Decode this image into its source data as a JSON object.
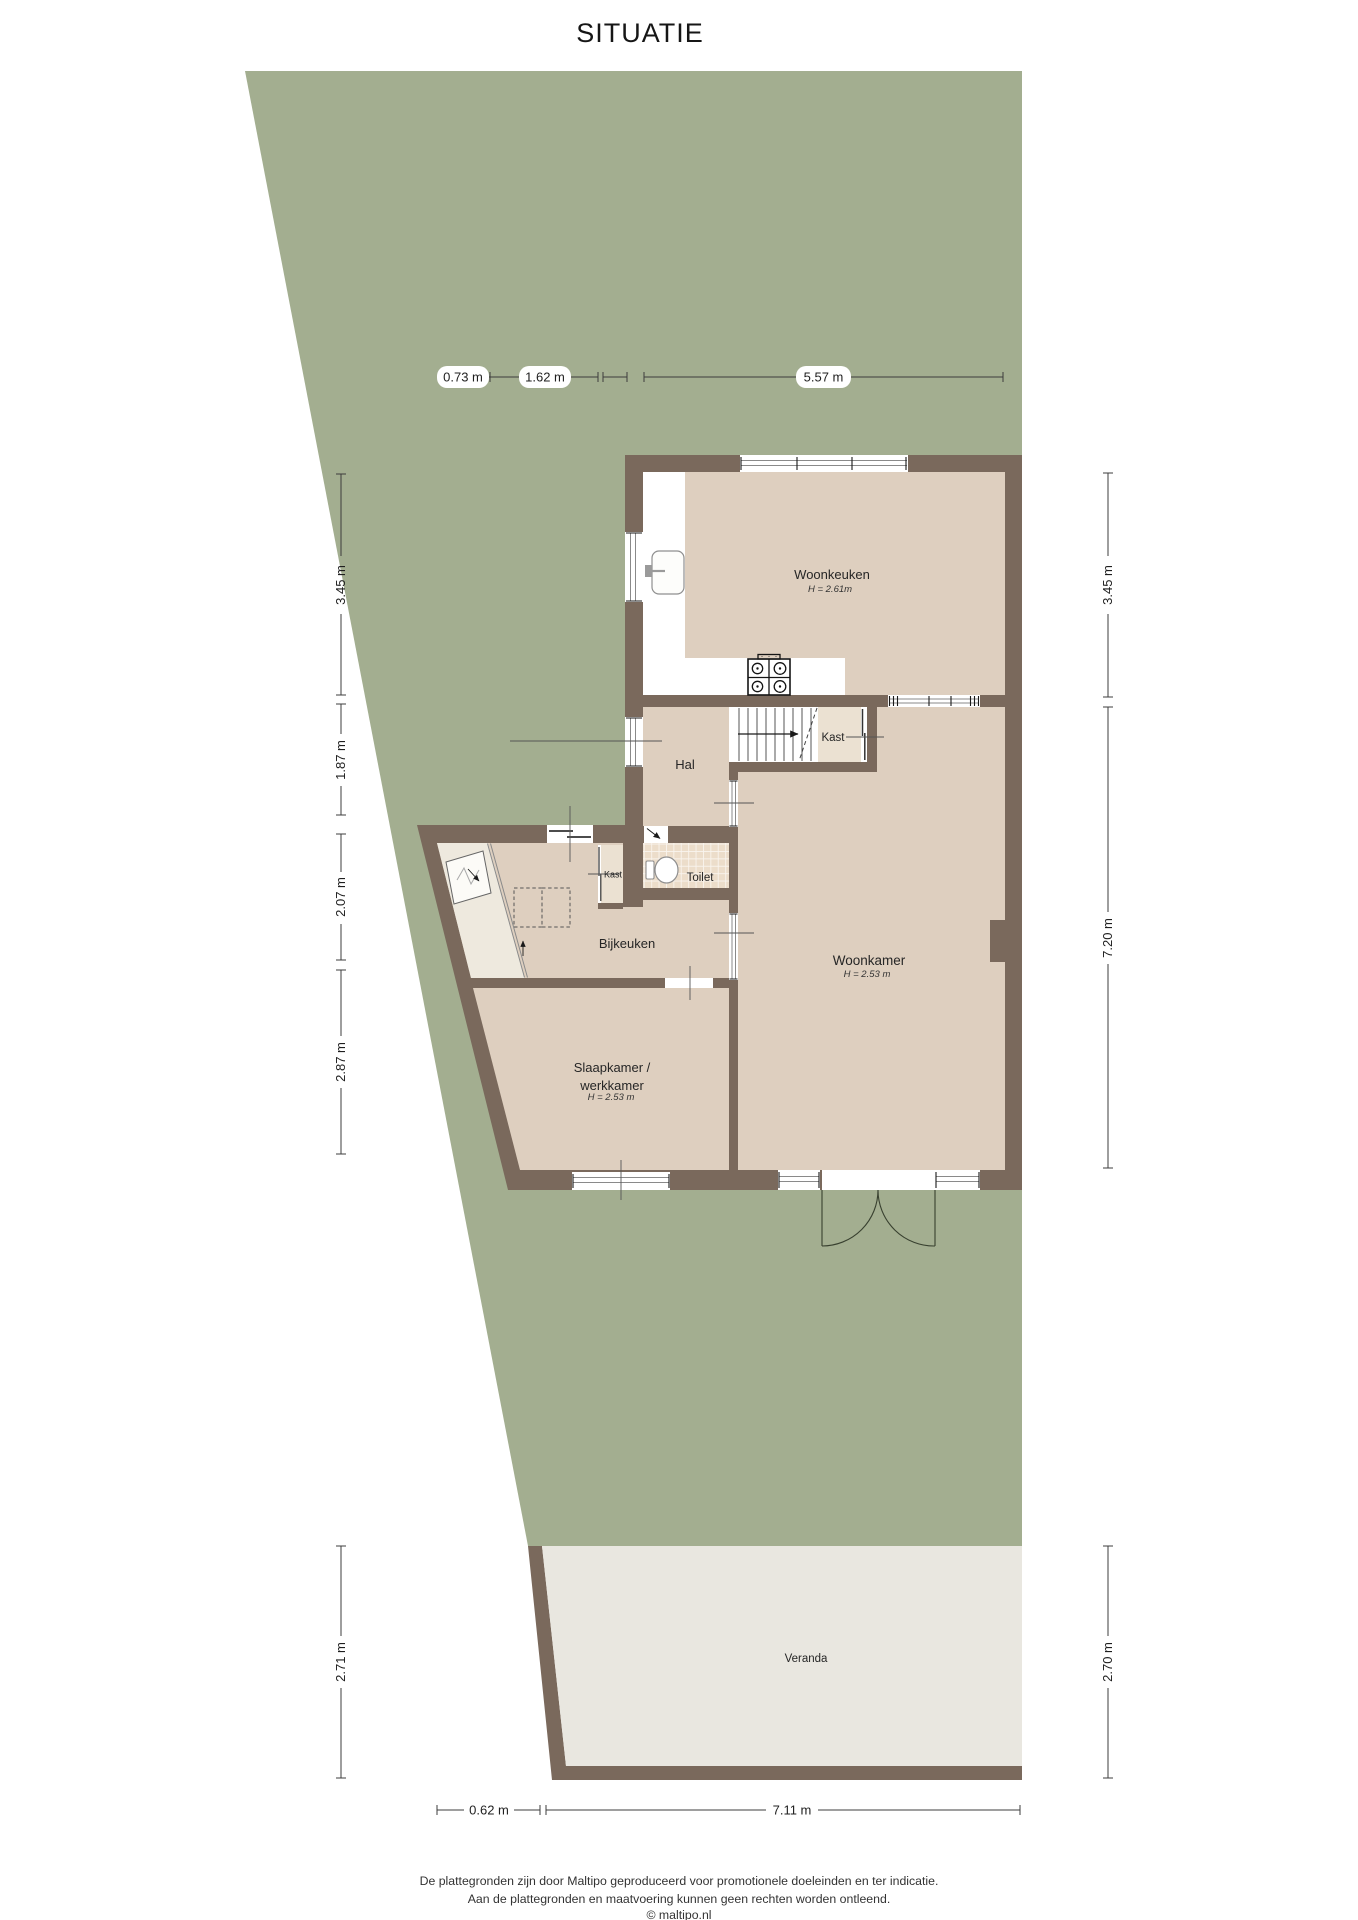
{
  "title": "SITUATIE",
  "colors": {
    "garden": "#a3ae90",
    "wall": "#7a695c",
    "floor": "#decfbf",
    "floor_light": "#ebe1d2",
    "floor_entry": "#eee9de",
    "veranda_floor": "#e9e7e0",
    "tile": "#ecddca"
  },
  "rooms": {
    "woonkeuken": {
      "label": "Woonkeuken",
      "height": "H = 2.61m"
    },
    "hal": {
      "label": "Hal"
    },
    "kast_stairs": {
      "label": "Kast"
    },
    "toilet": {
      "label": "Toilet"
    },
    "kast_bijkeuken": {
      "label": "Kast"
    },
    "bijkeuken": {
      "label": "Bijkeuken"
    },
    "woonkamer": {
      "label": "Woonkamer",
      "height": "H = 2.53 m"
    },
    "slaapkamer": {
      "label_line1": "Slaapkamer /",
      "label_line2": "werkkamer",
      "height": "H = 2.53 m"
    },
    "veranda": {
      "label": "Veranda"
    }
  },
  "dimensions": {
    "top": [
      "0.73 m",
      "1.62 m",
      "5.57 m"
    ],
    "left": [
      "3.45 m",
      "1.87 m",
      "2.07 m",
      "2.87 m",
      "2.71 m"
    ],
    "right": [
      "3.45 m",
      "7.20 m",
      "2.70 m"
    ],
    "bottom": [
      "0.62 m",
      "7.11 m"
    ]
  },
  "footer": {
    "line1": "De plattegronden zijn door Maltipo geproduceerd voor promotionele doeleinden en ter indicatie.",
    "line2": "Aan de plattegronden en maatvoering kunnen geen rechten worden ontleend.",
    "line3": "© maltipo.nl"
  }
}
